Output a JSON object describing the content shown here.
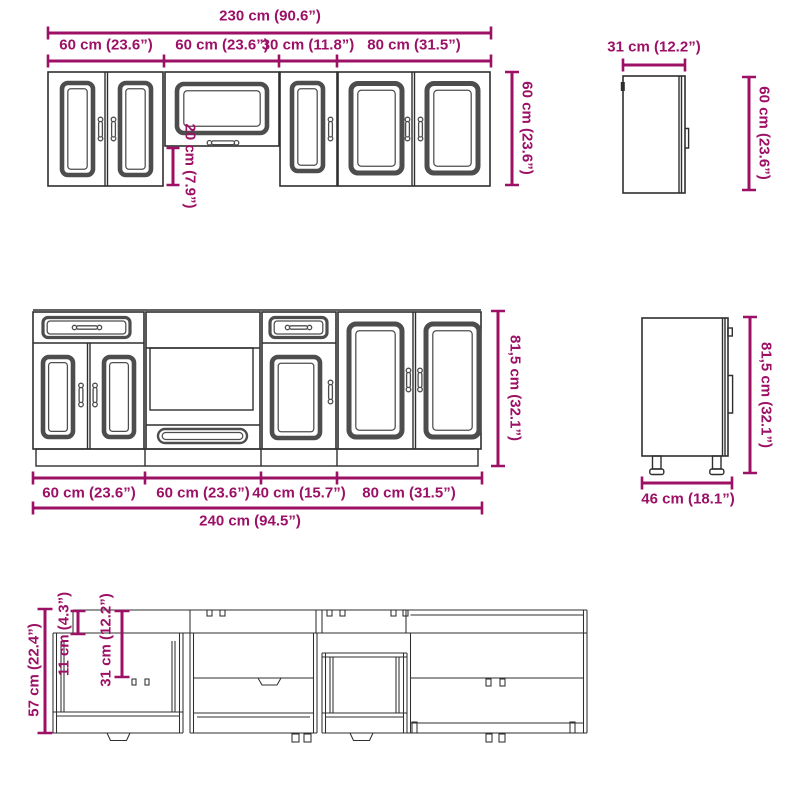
{
  "colors": {
    "dimension": "#9c1066",
    "line": "#2f2f2f",
    "panel": "#4d4d4d",
    "background": "#ffffff"
  },
  "dims": {
    "wall_front": {
      "total": "230 cm (90.6”)",
      "units": [
        "60 cm (23.6”)",
        "60 cm (23.6”)",
        "30 cm (11.8”)",
        "80 cm (31.5”)"
      ],
      "height": "60 cm (23.6”)",
      "flip_gap": "20 cm (7.9”)"
    },
    "wall_side": {
      "width": "31 cm (12.2”)",
      "height": "60 cm (23.6”)"
    },
    "base_front": {
      "units": [
        "60 cm (23.6”)",
        "60 cm (23.6”)",
        "40 cm (15.7”)",
        "80 cm (31.5”)"
      ],
      "total": "240 cm (94.5”)",
      "height": "81,5 cm (32.1”)"
    },
    "base_side": {
      "width": "46 cm (18.1”)",
      "height": "81,5 cm (32.1”)"
    },
    "drawer_detail": {
      "height": "57 cm (22.4”)",
      "top": "11 cm (4.3”)",
      "mid": "31 cm (12.2”)"
    }
  }
}
